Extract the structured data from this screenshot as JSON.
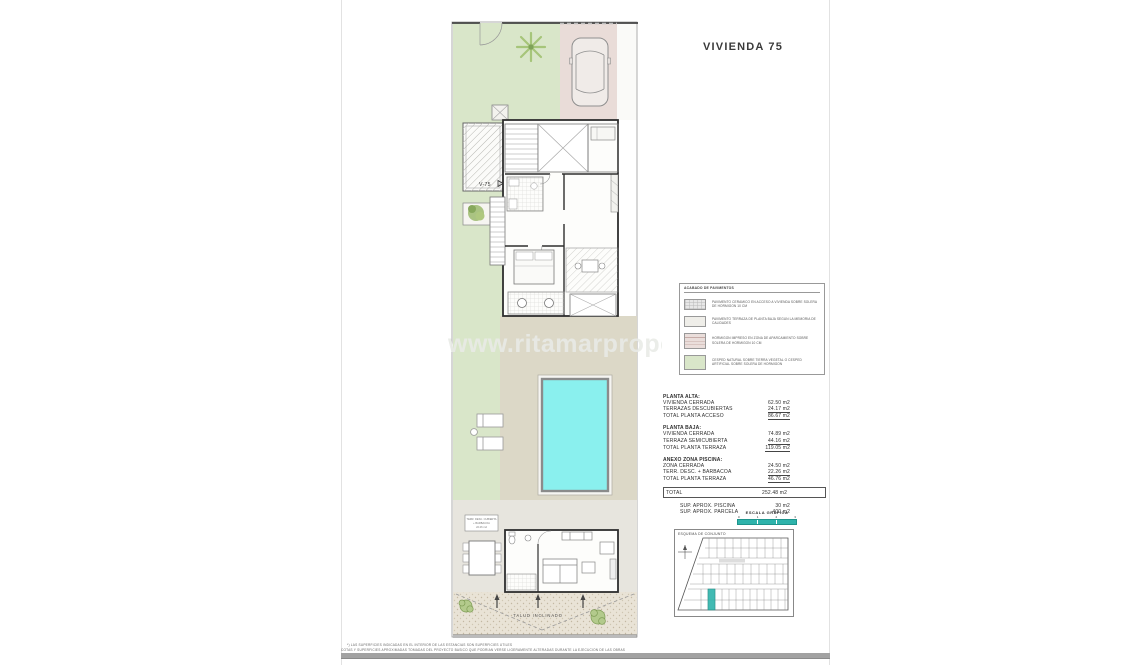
{
  "title": "VIVIENDA 75",
  "watermark": "www.ritamarproper",
  "plan": {
    "unit_label": "V-75",
    "slope_label": "TALUD INCLINADO",
    "note_box": {
      "line1": "TERR. DESC. CUBIERTA",
      "line2": "+ BARBACOA",
      "line3": "22.26 m2"
    }
  },
  "legend": {
    "title": "ACABADO DE PAVIMENTOS",
    "items": [
      {
        "name": "ceramic-paving",
        "color": "#e7e7e7",
        "text": "PAVIMENTO CERAMICO EN ACCESO A VIVIENDA SOBRE SOLERA DE HORMIGON 10 cm"
      },
      {
        "name": "terrace-paving",
        "color": "#efeee9",
        "text": "PAVIMENTO TERRAZA DE PLANTA BAJA SEGUN LA MEMORIA DE CALIDADES"
      },
      {
        "name": "printed-concrete",
        "color": "#eadedb",
        "text": "HORMIGON IMPRESO EN ZONA DE APARCAMIENTO SOBRE SOLERA DE HORMIGON 10 cm"
      },
      {
        "name": "lawn",
        "color": "#d9e6c9",
        "text": "CESPED NATURAL SOBRE TIERRA VEGETAL O CESPED ARTIFICIAL SOBRE SOLERA DE HORMIGON"
      }
    ]
  },
  "areas": {
    "sections": [
      {
        "heading": "PLANTA ALTA:",
        "rows": [
          {
            "label": "VIVIENDA CERRADA",
            "value": "62.50 m2"
          },
          {
            "label": "TERRAZAS DESCUBIERTAS",
            "value": "24.17 m2"
          },
          {
            "label": "TOTAL PLANTA ACCESO",
            "value": "86.67 m2"
          }
        ]
      },
      {
        "heading": "PLANTA BAJA:",
        "rows": [
          {
            "label": "VIVIENDA CERRADA",
            "value": "74.89 m2"
          },
          {
            "label": "TERRAZA SEMICUBIERTA",
            "value": "44.16 m2"
          },
          {
            "label": "TOTAL PLANTA TERRAZA",
            "value": "119.05 m2"
          }
        ]
      },
      {
        "heading": "ANEXO ZONA PISCINA:",
        "rows": [
          {
            "label": "ZONA CERRADA",
            "value": "24.50 m2"
          },
          {
            "label": "TERR. DESC. + BARBACOA",
            "value": "22.26 m2"
          },
          {
            "label": "TOTAL PLANTA TERRAZA",
            "value": "46.76 m2"
          }
        ]
      }
    ],
    "total": {
      "label": "TOTAL",
      "value": "252.48 m2"
    },
    "extras": [
      {
        "label": "SUP.  APROX.  PISCINA",
        "value": "30 m2"
      },
      {
        "label": "SUP.  APROX.  PARCELA",
        "value": "400 m2"
      }
    ]
  },
  "scale_bar": {
    "title": "ESCALA GRAFICA",
    "ticks": [
      "0",
      "1",
      "2",
      "3"
    ]
  },
  "site_plan": {
    "title": "ESQUEMA DE CONJUNTO"
  },
  "footer": {
    "line1": "*) LAS SUPERFICIES INDICADAS EN EL INTERIOR DE LAS ESTANCIAS SON SUPERFICIES UTILES",
    "line2": "COTAS Y SUPERFICIES APROXIMADAS TOMADAS DEL PROYECTO BASICO QUE PODRIAN VERSE LIGERAMENTE ALTERADAS DURANTE LA EJECUCION DE LAS OBRAS"
  },
  "colors": {
    "accent_teal": "#2eb3ab",
    "pool_water": "#8af0ee",
    "garden_green": "#d9e6c9",
    "driveway_pink": "#e9dcd8",
    "deck_beige": "#dcd8c7"
  }
}
